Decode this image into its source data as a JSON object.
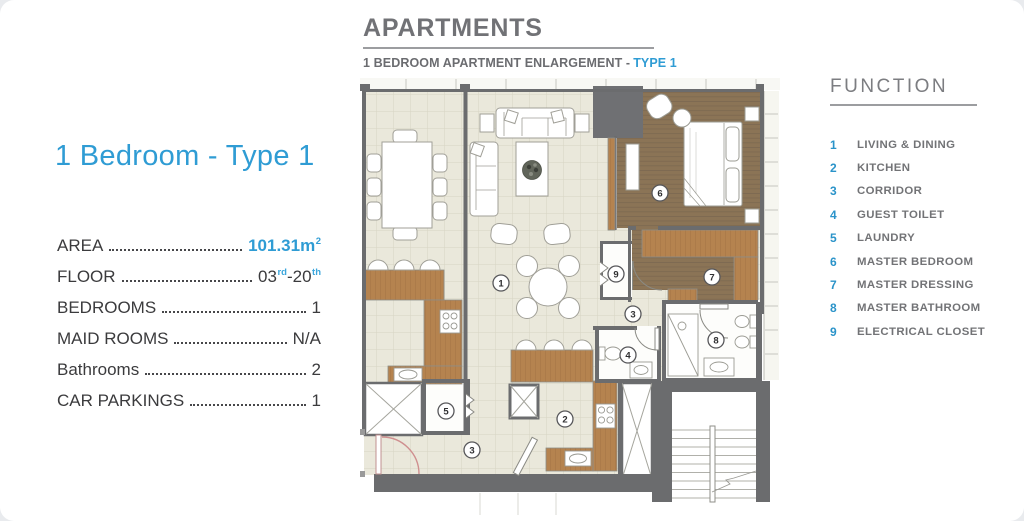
{
  "colors": {
    "accent_blue": "#2f9cd4",
    "function_number_blue": "#2a93c9",
    "heading_gray": "#717276",
    "text_dark": "#3b3b3d",
    "wall_gray": "#6b6c6e",
    "tile_cream": "#eae8db",
    "wood_brown": "#8b7456",
    "cabinet_brown": "#b5834f",
    "entrance_arc_red": "#cf8f8f"
  },
  "unit_panel": {
    "title": "1 Bedroom - Type 1",
    "specs": {
      "area": {
        "label": "AREA",
        "value": "101.31m",
        "sup": "2"
      },
      "floor": {
        "label": "FLOOR",
        "value_start": "03",
        "sup_start": "rd",
        "value_end": "-20",
        "sup_end": "th"
      },
      "bedrooms": {
        "label": "BEDROOMS",
        "value": "1"
      },
      "maid_rooms": {
        "label": "MAID ROOMS",
        "value": "N/A"
      },
      "bathrooms": {
        "label": "Bathrooms",
        "value": "2"
      },
      "car_parkings": {
        "label": "CAR PARKINGS",
        "value": "1"
      }
    }
  },
  "plan_header": {
    "title": "APARTMENTS",
    "subtitle": "1 BEDROOM APARTMENT ENLARGEMENT -",
    "subtitle_accent": "TYPE 1"
  },
  "function_panel": {
    "title": "FUNCTION",
    "items": [
      {
        "num": "1",
        "label": "LIVING & DINING"
      },
      {
        "num": "2",
        "label": "KITCHEN"
      },
      {
        "num": "3",
        "label": "CORRIDOR"
      },
      {
        "num": "4",
        "label": "GUEST TOILET"
      },
      {
        "num": "5",
        "label": "LAUNDRY"
      },
      {
        "num": "6",
        "label": "MASTER BEDROOM"
      },
      {
        "num": "7",
        "label": "MASTER DRESSING"
      },
      {
        "num": "8",
        "label": "MASTER BATHROOM"
      },
      {
        "num": "9",
        "label": "ELECTRICAL CLOSET"
      }
    ]
  },
  "floor_plan": {
    "markers": [
      {
        "num": "1"
      },
      {
        "num": "2"
      },
      {
        "num": "3"
      },
      {
        "num": "3"
      },
      {
        "num": "4"
      },
      {
        "num": "5"
      },
      {
        "num": "6"
      },
      {
        "num": "7"
      },
      {
        "num": "8"
      },
      {
        "num": "9"
      }
    ]
  }
}
